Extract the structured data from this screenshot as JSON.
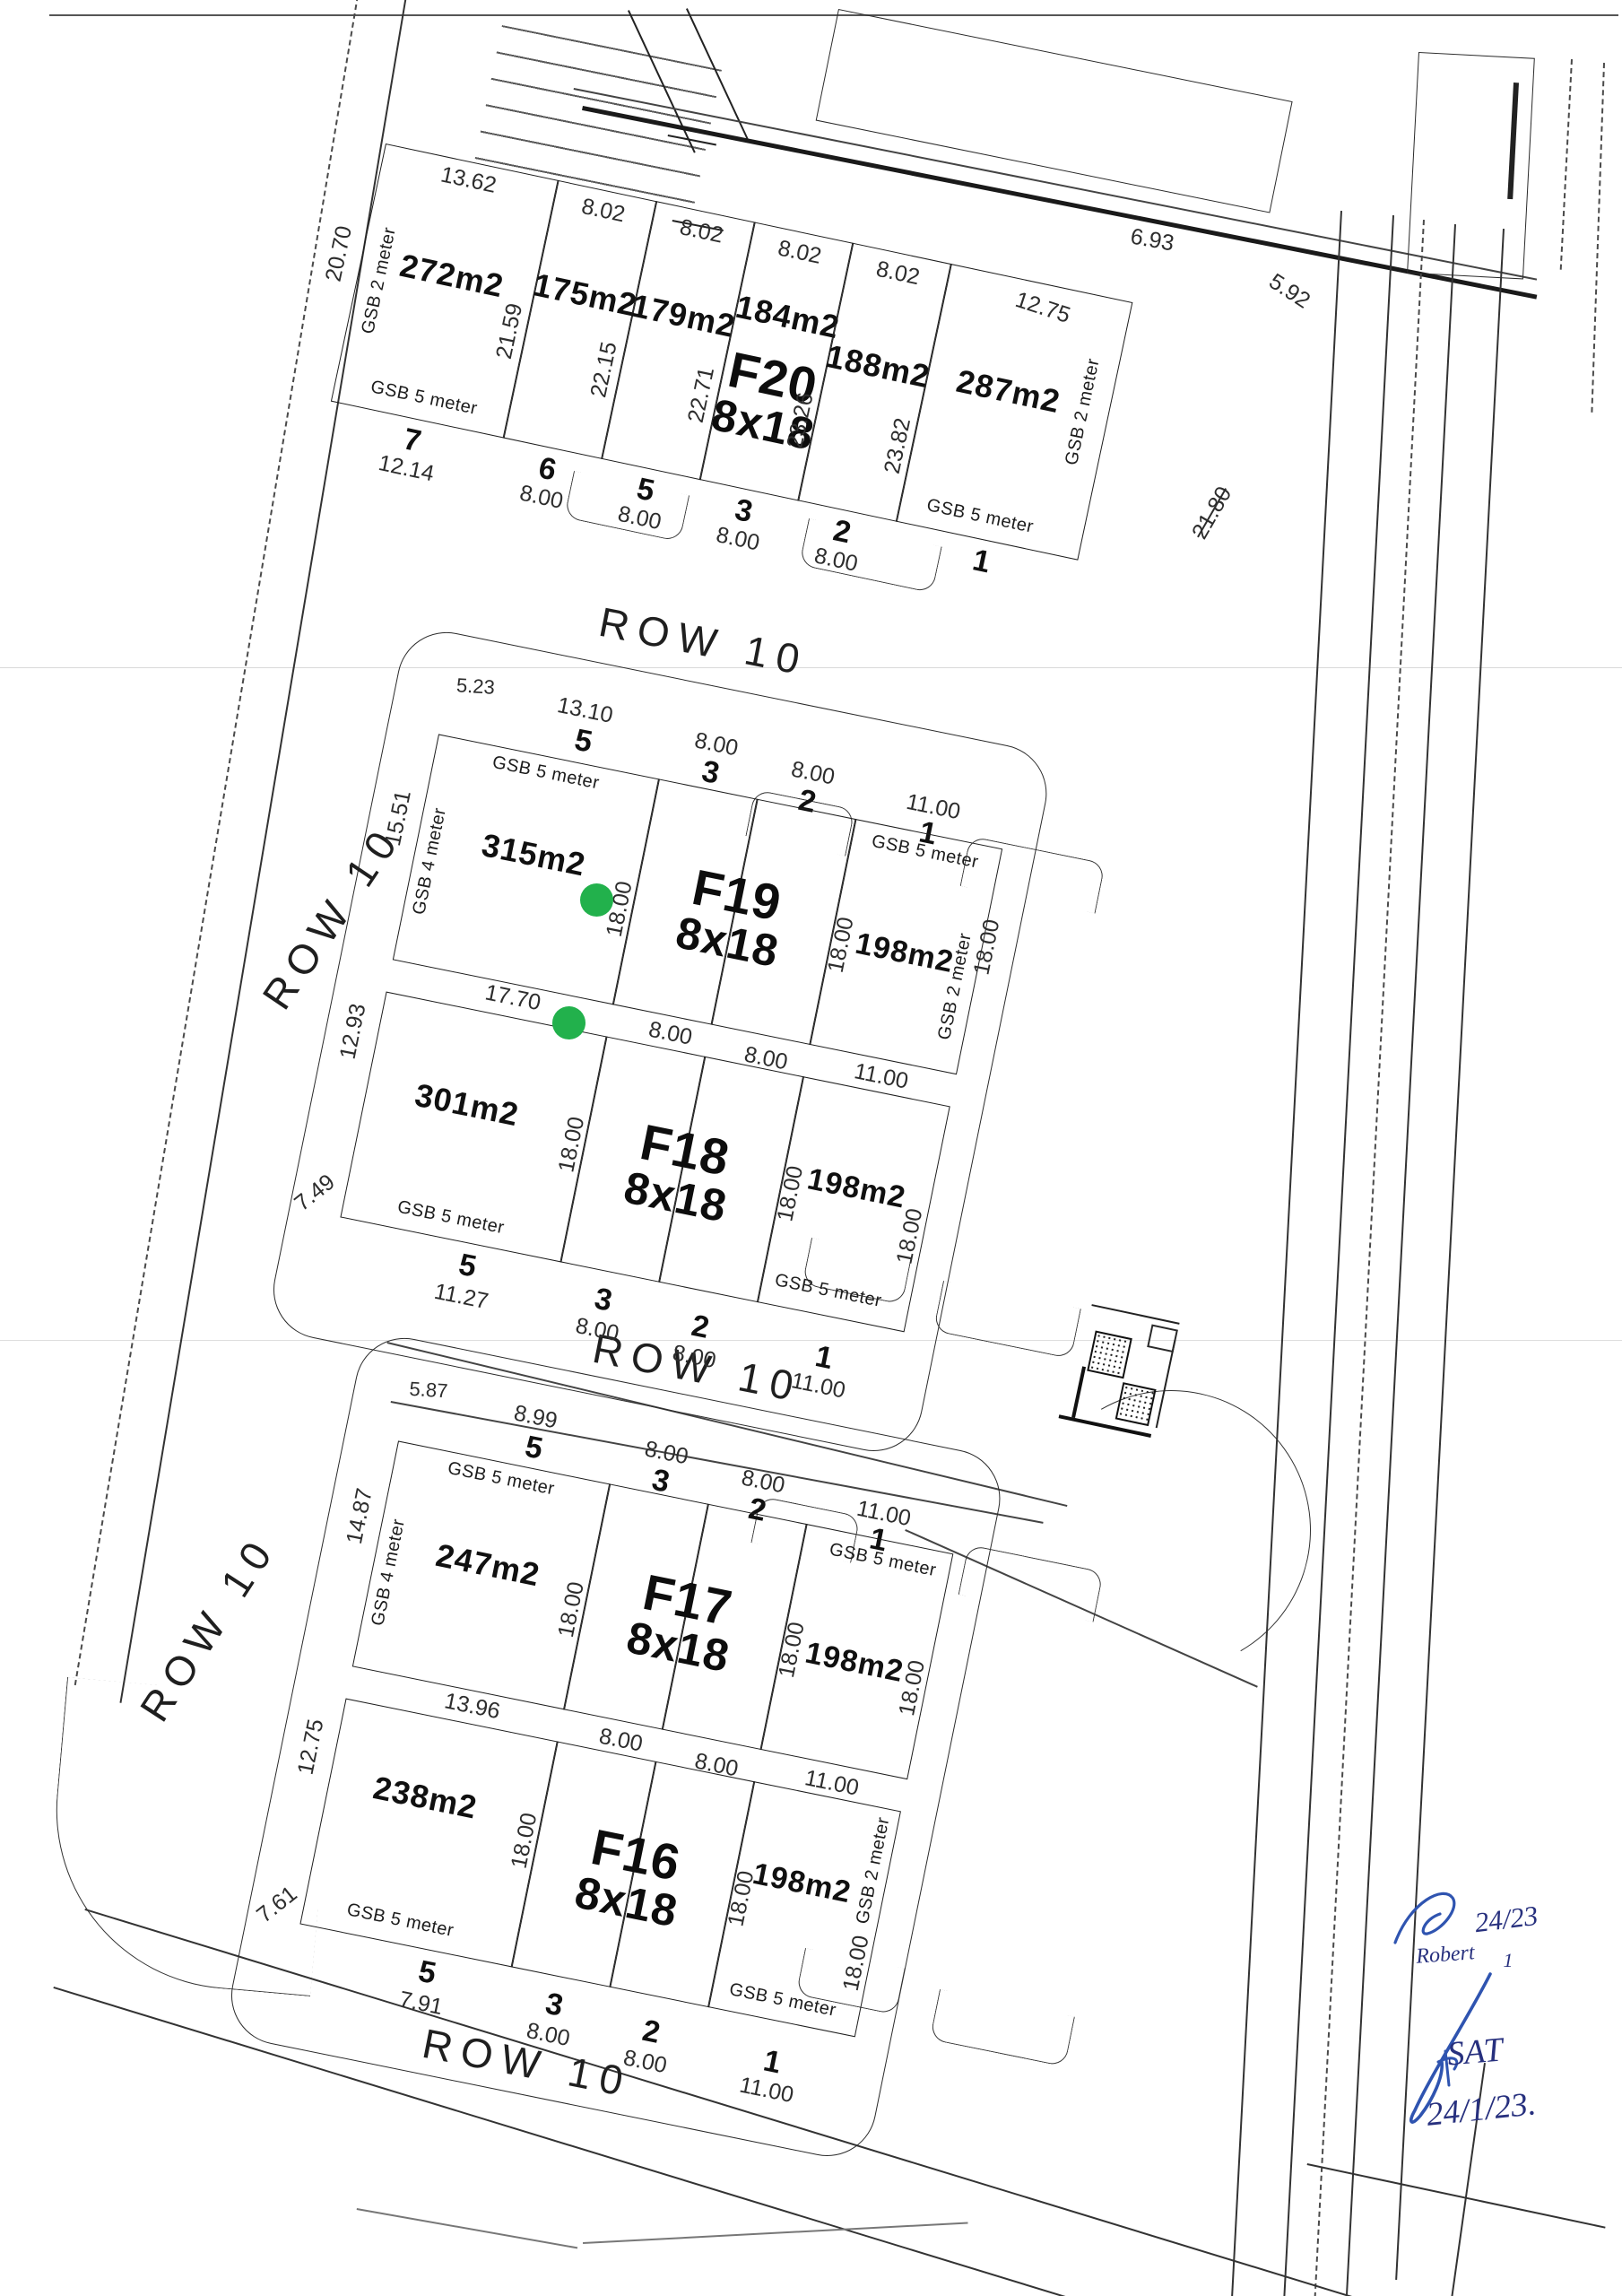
{
  "streets": {
    "row_label": "ROW 10"
  },
  "survey": {
    "f20": {
      "label": "F20",
      "size": "8x18",
      "plots": [
        {
          "num": "7",
          "area": "272m2",
          "top": "13.62",
          "left": "20.70",
          "right": "21.59",
          "gsb_left": "GSB 2 meter",
          "gsb_bottom": "GSB 5 meter",
          "bottom": "12.14"
        },
        {
          "num": "6",
          "area": "175m2",
          "top": "8.02",
          "right": "22.15",
          "bottom": "8.00"
        },
        {
          "num": "5",
          "area": "179m2",
          "top": "8.02",
          "right": "22.71",
          "bottom": "8.00"
        },
        {
          "num": "3",
          "area": "184m2",
          "top": "8.02",
          "right": "23.26",
          "bottom": "8.00"
        },
        {
          "num": "2",
          "area": "188m2",
          "top": "8.02",
          "right": "23.82",
          "bottom": "8.00"
        },
        {
          "num": "1",
          "area": "287m2",
          "top": "12.75",
          "gsb_right": "GSB 2 meter",
          "gsb_bottom": "GSB 5 meter"
        }
      ]
    },
    "f19": {
      "label": "F19",
      "size": "8x18",
      "header": {
        "corner": "5.23",
        "c1_dim": "13.10",
        "c1_num": "5",
        "c2_dim": "8.00",
        "c2_num": "3",
        "c3_dim": "8.00",
        "c3_num": "2",
        "c4_dim": "11.00",
        "c4_num": "1"
      },
      "left_plot": {
        "area": "315m2",
        "gsb_top": "GSB 5 meter",
        "gsb_left": "GSB 4 meter",
        "left": "15.51",
        "right": "18.00"
      },
      "right_plot": {
        "area": "198m2",
        "gsb_top": "GSB 5 meter",
        "left": "18.00",
        "right": "18.00",
        "gsb_right": "GSB 2 meter"
      }
    },
    "f18": {
      "label": "F18",
      "size": "8x18",
      "mid_dims": {
        "c1": "17.70",
        "c2": "8.00",
        "c3": "8.00",
        "c4": "11.00"
      },
      "left_plot": {
        "area": "301m2",
        "left_top": "12.93",
        "corner": "7.49",
        "right": "18.00",
        "gsb_bottom": "GSB 5 meter"
      },
      "right_plot": {
        "area": "198m2",
        "left": "18.00",
        "right": "18.00",
        "gsb_bottom": "GSB 5 meter"
      },
      "footer": {
        "c1_num": "5",
        "c1_dim": "11.27",
        "c2_num": "3",
        "c2_dim": "8.00",
        "c3_num": "2",
        "c3_dim": "8.00",
        "c4_num": "1",
        "c4_dim": "11.00"
      }
    },
    "f17": {
      "label": "F17",
      "size": "8x18",
      "header": {
        "corner": "5.87",
        "c1_dim": "8.99",
        "c1_num": "5",
        "c2_dim": "8.00",
        "c2_num": "3",
        "c3_dim": "8.00",
        "c3_num": "2",
        "c4_dim": "11.00",
        "c4_num": "1"
      },
      "left_plot": {
        "area": "247m2",
        "gsb_top": "GSB 5 meter",
        "gsb_left": "GSB 4 meter",
        "left": "14.87",
        "right": "18.00"
      },
      "right_plot": {
        "area": "198m2",
        "gsb_top": "GSB 5 meter",
        "left": "18.00",
        "right": "18.00"
      }
    },
    "f16": {
      "label": "F16",
      "size": "8x18",
      "mid_dims": {
        "c1": "13.96",
        "c2": "8.00",
        "c3": "8.00",
        "c4": "11.00"
      },
      "left_plot": {
        "area": "238m2",
        "left_top": "12.75",
        "corner": "7.61",
        "right": "18.00",
        "gsb_bottom": "GSB 5 meter"
      },
      "right_plot": {
        "area": "198m2",
        "left": "18.00",
        "right": "18.00",
        "gsb_right": "GSB 2 meter",
        "gsb_bottom": "GSB 5 meter"
      },
      "footer": {
        "c1_num": "5",
        "c1_dim": "7.91",
        "c2_num": "3",
        "c2_dim": "8.00",
        "c3_num": "2",
        "c3_dim": "8.00",
        "c4_num": "1",
        "c4_dim": "11.00"
      }
    }
  },
  "annotations": {
    "dim_693": "6.93",
    "dim_592": "5.92",
    "dim_2180_printed": "21.80",
    "dim_2155_handwritten": "21,55"
  },
  "handwriting": {
    "name1": "Robert",
    "date1": "24/23",
    "date1_sub": "1",
    "name2": "SAT",
    "date2": "24/1/23."
  },
  "markers": {
    "dot_color": "#22b14c",
    "count": 2
  }
}
